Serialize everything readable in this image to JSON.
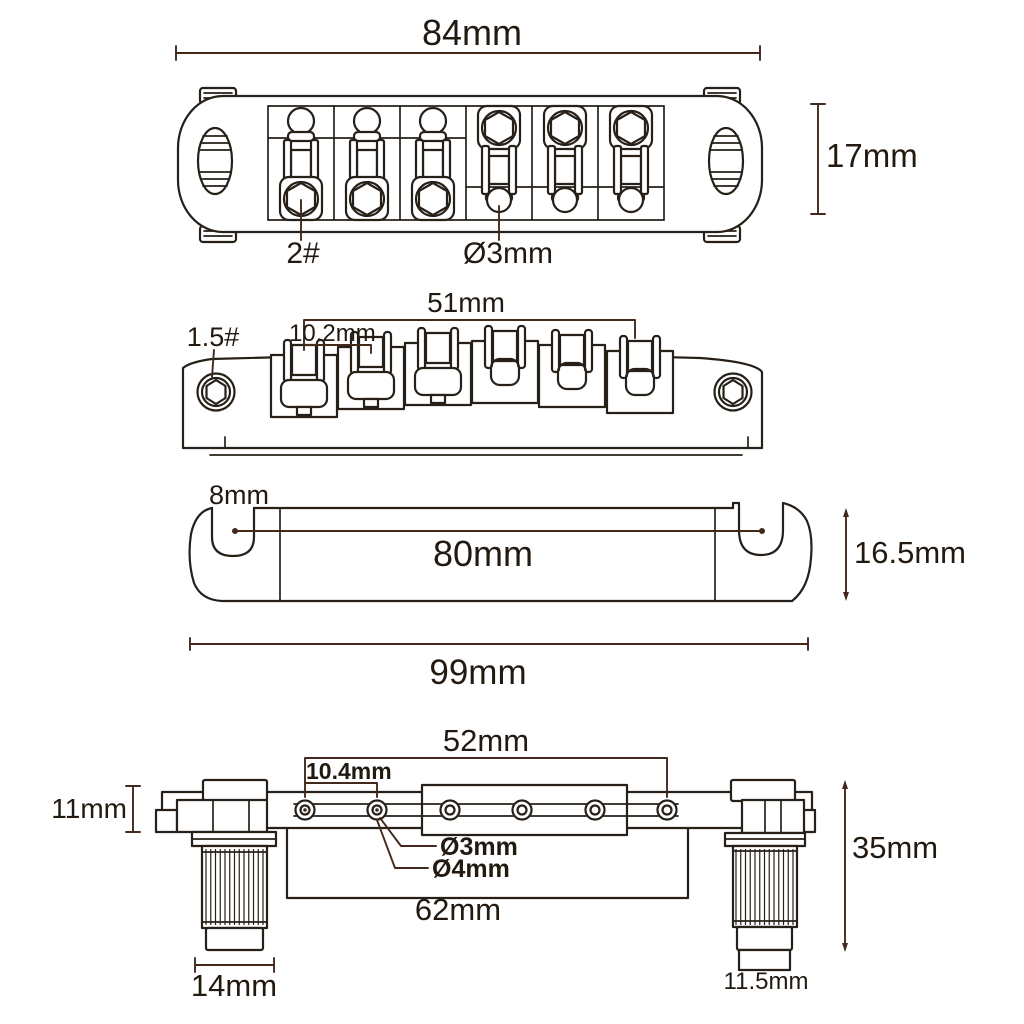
{
  "diagram": {
    "background": "#ffffff",
    "line_color": "#262019",
    "dimension_color": "#43291c",
    "text_color": "#221910",
    "views": {
      "bridge_top": {
        "width": "84mm",
        "height": "17mm",
        "screw_gauge": "2#",
        "string_hole": "Ø3mm"
      },
      "bridge_front": {
        "saddle_span": "51mm",
        "string_spacing": "10.2mm",
        "wrench_size": "1.5#"
      },
      "tailpiece_side": {
        "notch_width": "8mm",
        "anchor_span": "80mm",
        "height": "16.5mm",
        "overall_width": "99mm"
      },
      "tailpiece_back": {
        "hole_span": "52mm",
        "hole_spacing": "10.4mm",
        "head_height": "11mm",
        "string_hole": "Ø3mm",
        "anchor_hole": "Ø4mm",
        "body_width": "62mm",
        "stud_height": "35mm",
        "bushing_width": "14mm",
        "stud_width": "11.5mm"
      }
    }
  }
}
